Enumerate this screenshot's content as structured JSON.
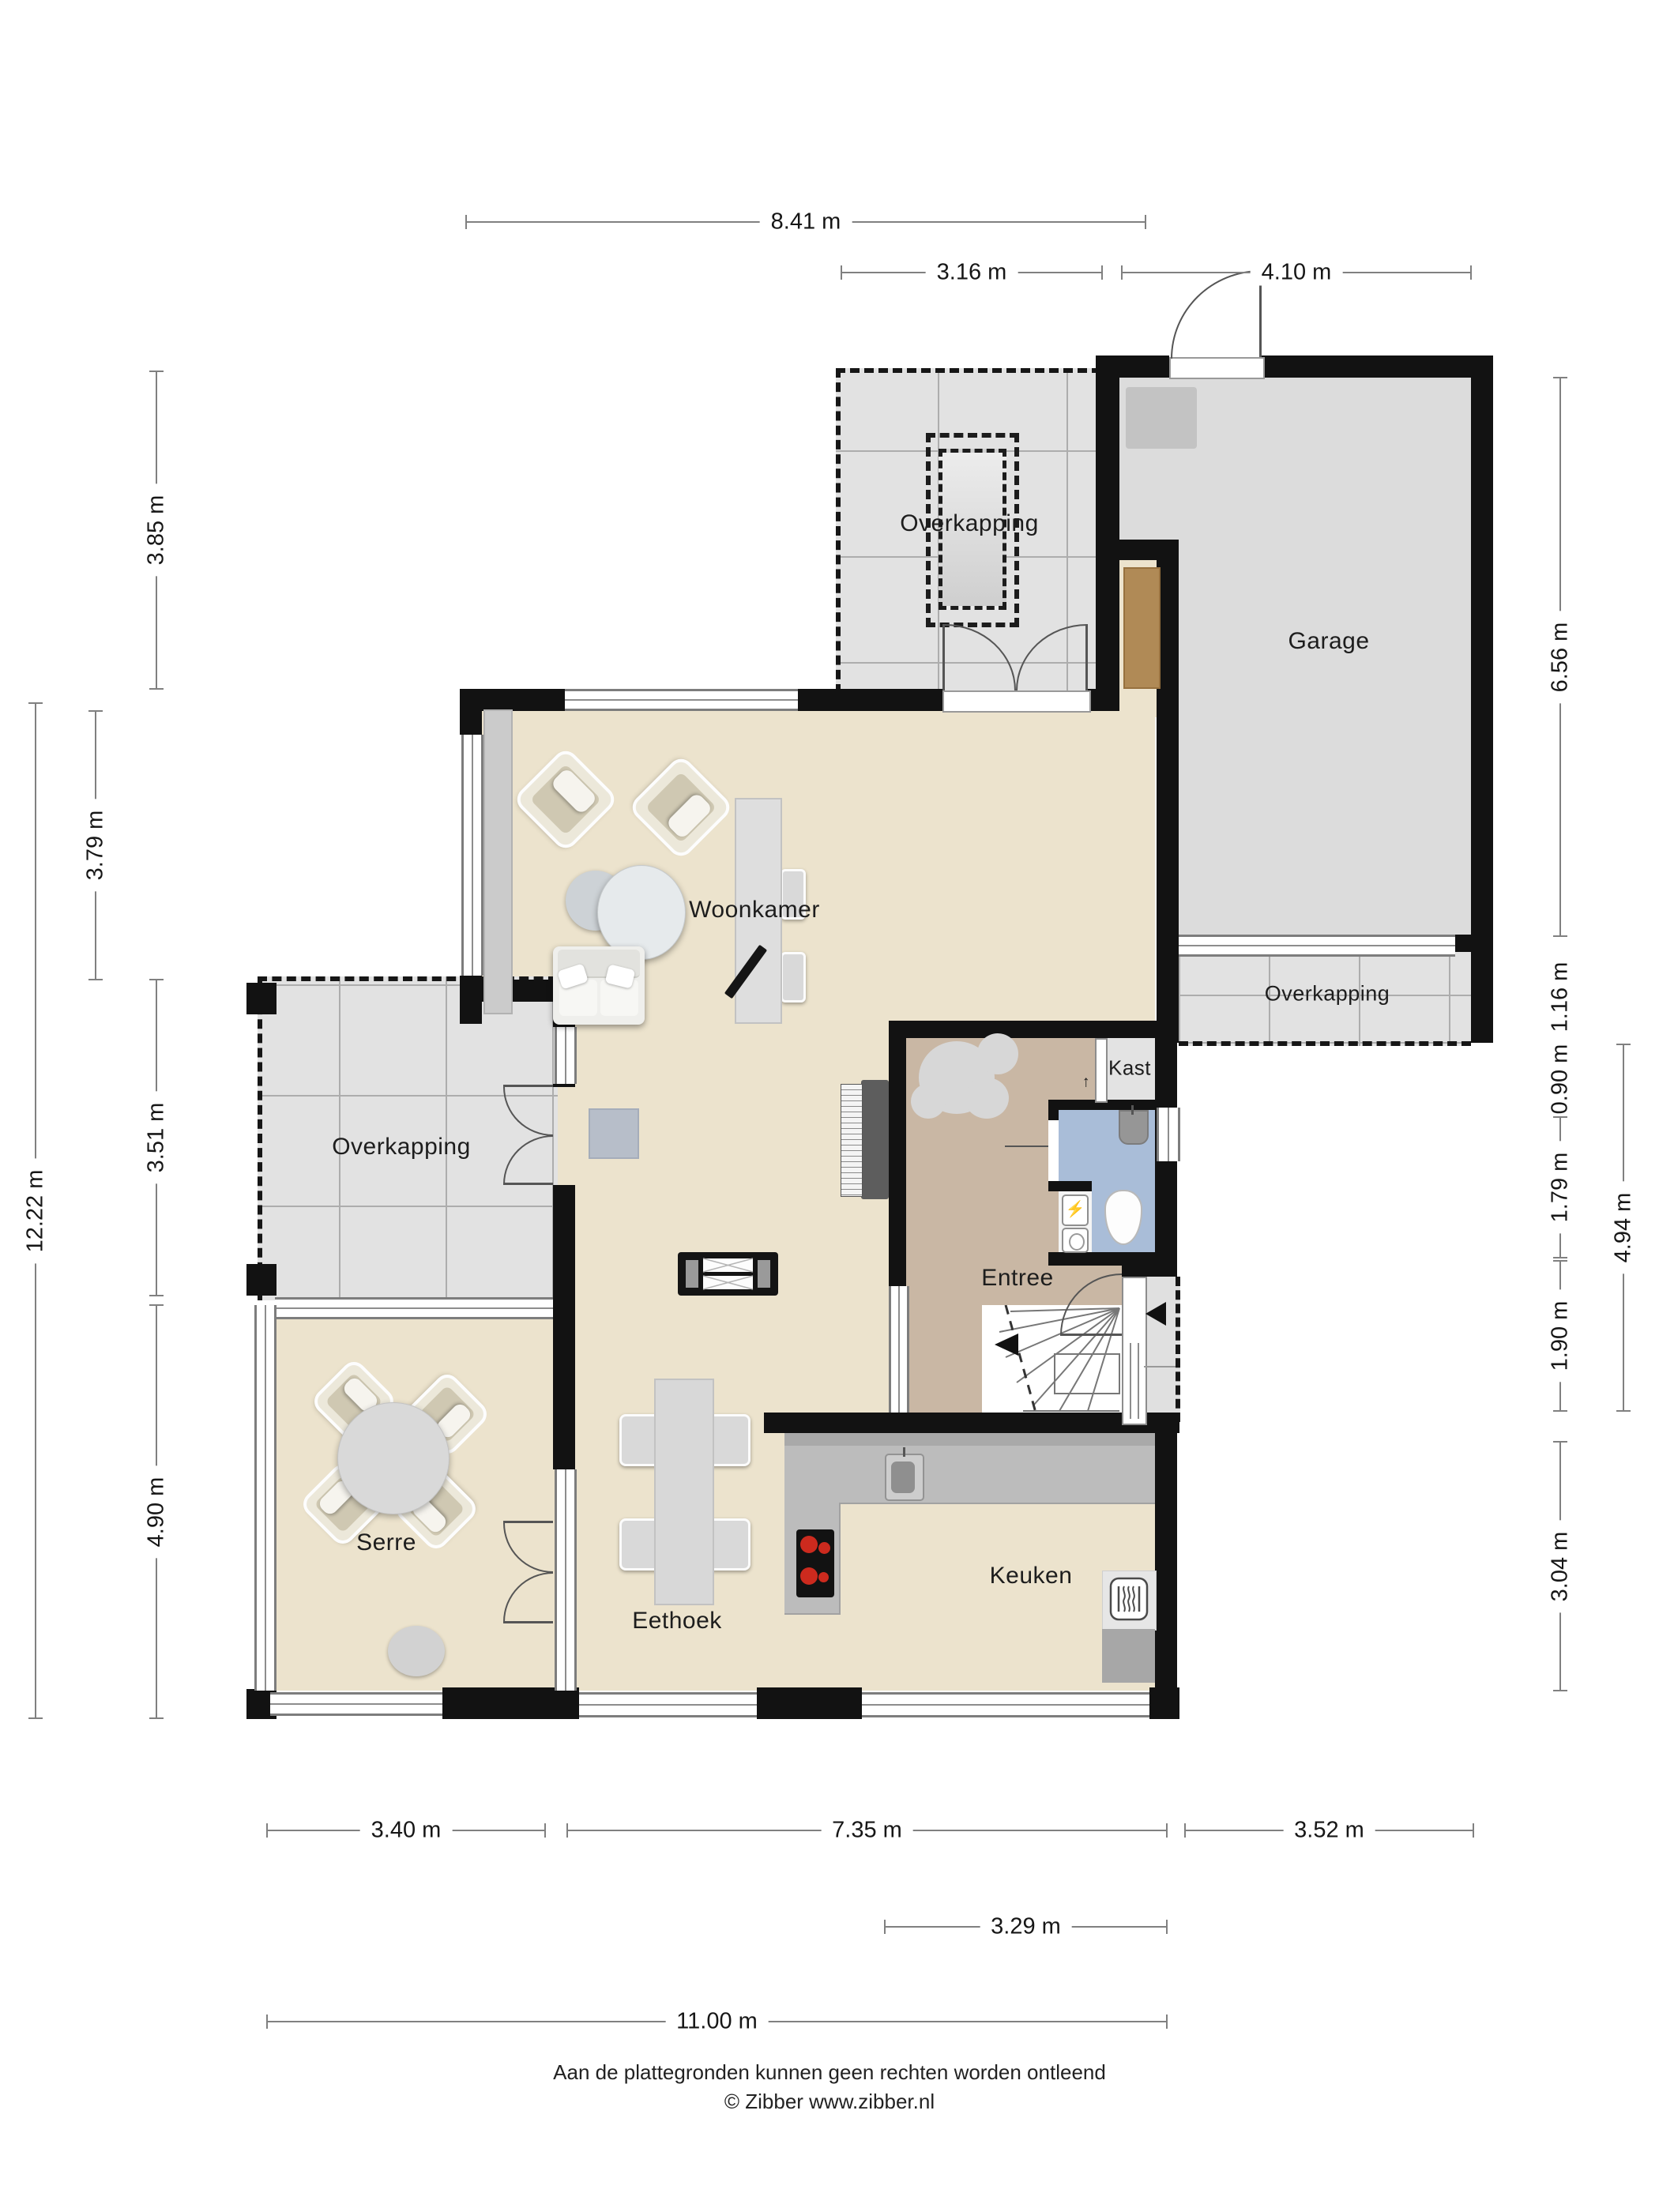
{
  "title": "Begane grond plattegrond",
  "rooms": {
    "overkapping_top": "Overkapping",
    "garage": "Garage",
    "overkapping_right": "Overkapping",
    "woonkamer": "Woonkamer",
    "kast": "Kast",
    "entree": "Entree",
    "overkapping_left": "Overkapping",
    "serre": "Serre",
    "eethoek": "Eethoek",
    "keuken": "Keuken"
  },
  "dims": {
    "top_total": "8.41 m",
    "top_overkapping": "3.16 m",
    "top_garage": "4.10 m",
    "left_overkapping_top": "3.85 m",
    "left_woonkamer": "3.79 m",
    "left_overkapping": "3.51 m",
    "left_total": "12.22 m",
    "left_serre": "4.90 m",
    "right_garage": "6.56 m",
    "right_overkapping": "1.16 m",
    "right_kast": "0.90 m",
    "right_toilet": "1.79 m",
    "right_hall": "1.90 m",
    "right_entree_total": "4.94 m",
    "right_keuken": "3.04 m",
    "bottom_serre": "3.40 m",
    "bottom_main": "7.35 m",
    "bottom_right": "3.52 m",
    "bottom_window": "3.29 m",
    "bottom_total": "11.00 m"
  },
  "footer": {
    "disclaimer": "Aan de plattegronden kunnen geen rechten worden ontleend",
    "copyright": "© Zibber www.zibber.nl"
  },
  "colors": {
    "wall": "#121212",
    "living_floor": "#ece3cd",
    "hall_floor": "#c9b7a4",
    "toilet_floor": "#a9bdd8",
    "terrace_floor": "#e2e2e2",
    "garage_floor": "#dcdcdc",
    "counter": "#bcbcbc",
    "burner_red": "#cc2a1e",
    "wood": "#b08a56"
  }
}
